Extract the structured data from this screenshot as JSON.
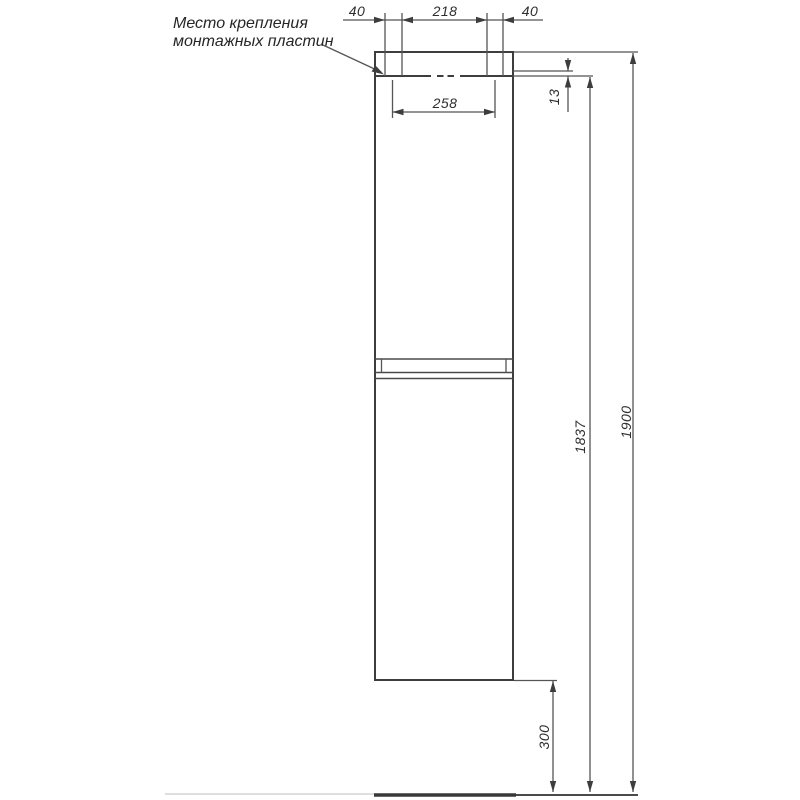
{
  "annotation": {
    "line1": "Место крепления",
    "line2": "монтажных пластин"
  },
  "dimensions": {
    "plate_width_left": "40",
    "plates_inner_span": "218",
    "plate_width_right": "40",
    "plates_center_span": "258",
    "mounting_offset": "13",
    "mounting_height": "1837",
    "overall_height": "1900",
    "bottom_clearance": "300"
  },
  "colors": {
    "outline": "#3d3d3d",
    "dimension": "#555555",
    "text": "#2e2e2e",
    "floor_dark": "#383838",
    "floor_light": "#cccccc",
    "background": "#ffffff"
  }
}
